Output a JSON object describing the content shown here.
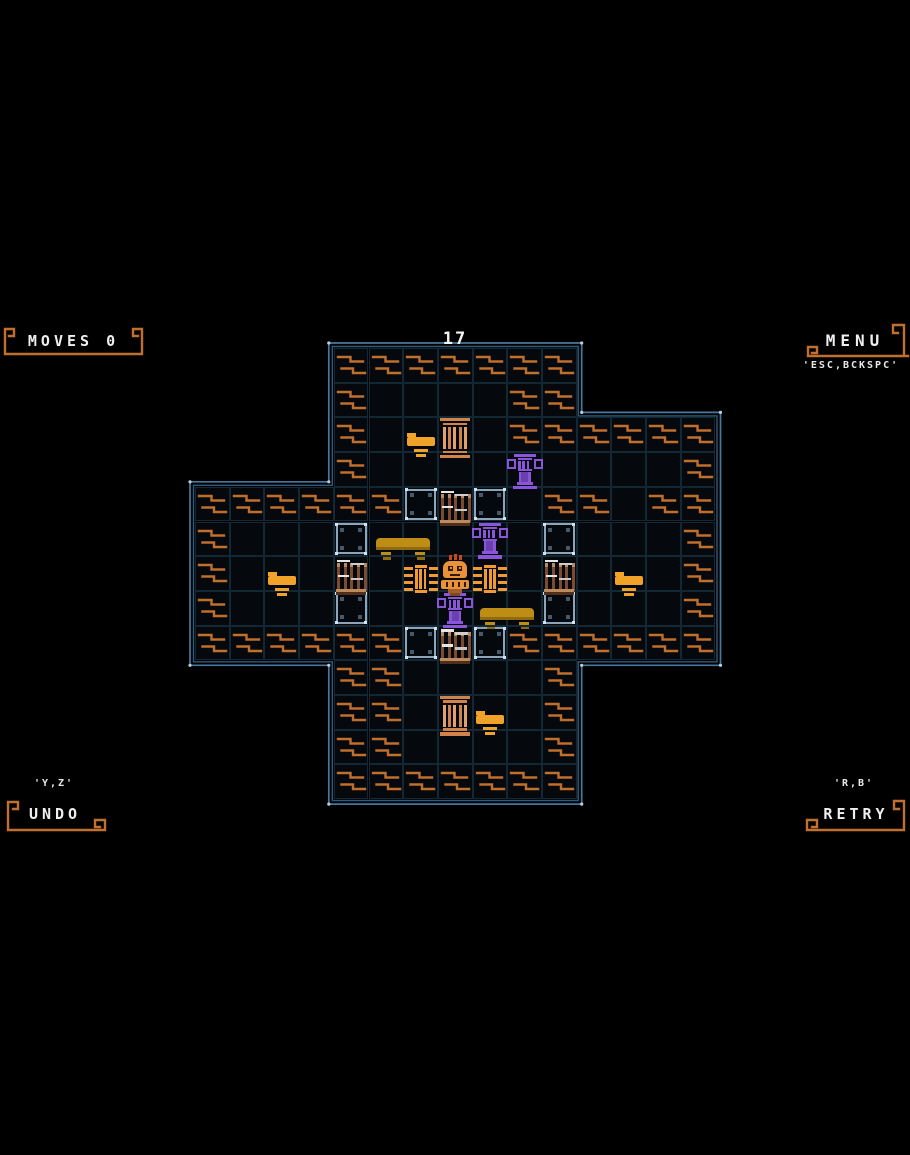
{
  "hud": {
    "moves_label": "MOVES 0",
    "level_number": "17",
    "menu_label": "MENU",
    "menu_keys": "'ESC,BCKSPC'",
    "undo_keys": "'Y,Z'",
    "undo_label": "UNDO",
    "retry_keys": "'R,B'",
    "retry_label": "RETRY"
  },
  "board": {
    "origin": {
      "x": 195,
      "y": 348
    },
    "cell_size": 34.7,
    "regions": [
      {
        "cols": [
          4,
          11
        ],
        "rows": [
          0,
          2
        ]
      },
      {
        "cols": [
          4,
          15
        ],
        "rows": [
          2,
          4
        ]
      },
      {
        "cols": [
          0,
          15
        ],
        "rows": [
          4,
          9
        ]
      },
      {
        "cols": [
          4,
          11
        ],
        "rows": [
          9,
          13
        ]
      }
    ],
    "outline_outer": [
      [
        328.8,
        343
      ],
      [
        581.7,
        343
      ],
      [
        581.7,
        412.4
      ],
      [
        720.5,
        412.4
      ],
      [
        720.5,
        665.3
      ],
      [
        581.7,
        665.3
      ],
      [
        581.7,
        804.1
      ],
      [
        328.8,
        804.1
      ],
      [
        328.8,
        665.3
      ],
      [
        190,
        665.3
      ],
      [
        190,
        481.8
      ],
      [
        328.8,
        481.8
      ]
    ],
    "outline_inner": [
      [
        332.3,
        346.5
      ],
      [
        578.2,
        346.5
      ],
      [
        578.2,
        415.9
      ],
      [
        717,
        415.9
      ],
      [
        717,
        661.8
      ],
      [
        578.2,
        661.8
      ],
      [
        578.2,
        800.6
      ],
      [
        332.3,
        800.6
      ],
      [
        332.3,
        661.8
      ],
      [
        193.5,
        661.8
      ],
      [
        193.5,
        485.3
      ],
      [
        332.3,
        485.3
      ]
    ],
    "waves": [
      [
        4,
        0
      ],
      [
        5,
        0
      ],
      [
        6,
        0
      ],
      [
        7,
        0
      ],
      [
        8,
        0
      ],
      [
        9,
        0
      ],
      [
        10,
        0
      ],
      [
        4,
        1
      ],
      [
        9,
        1
      ],
      [
        10,
        1
      ],
      [
        4,
        2
      ],
      [
        9,
        2
      ],
      [
        10,
        2
      ],
      [
        11,
        2
      ],
      [
        12,
        2
      ],
      [
        13,
        2
      ],
      [
        14,
        2
      ],
      [
        4,
        3
      ],
      [
        14,
        3
      ],
      [
        0,
        4
      ],
      [
        1,
        4
      ],
      [
        2,
        4
      ],
      [
        3,
        4
      ],
      [
        4,
        4
      ],
      [
        5,
        4
      ],
      [
        10,
        4
      ],
      [
        11,
        4
      ],
      [
        13,
        4
      ],
      [
        14,
        4
      ],
      [
        0,
        5
      ],
      [
        14,
        5
      ],
      [
        0,
        6
      ],
      [
        14,
        6
      ],
      [
        0,
        7
      ],
      [
        14,
        7
      ],
      [
        0,
        8
      ],
      [
        1,
        8
      ],
      [
        2,
        8
      ],
      [
        3,
        8
      ],
      [
        4,
        8
      ],
      [
        5,
        8
      ],
      [
        9,
        8
      ],
      [
        10,
        8
      ],
      [
        11,
        8
      ],
      [
        12,
        8
      ],
      [
        13,
        8
      ],
      [
        14,
        8
      ],
      [
        4,
        9
      ],
      [
        5,
        9
      ],
      [
        10,
        9
      ],
      [
        4,
        10
      ],
      [
        5,
        10
      ],
      [
        10,
        10
      ],
      [
        4,
        11
      ],
      [
        5,
        11
      ],
      [
        10,
        11
      ],
      [
        4,
        12
      ],
      [
        5,
        12
      ],
      [
        6,
        12
      ],
      [
        7,
        12
      ],
      [
        8,
        12
      ],
      [
        9,
        12
      ],
      [
        10,
        12
      ]
    ],
    "goals": [
      [
        6,
        4
      ],
      [
        8,
        4
      ],
      [
        4,
        5
      ],
      [
        10,
        5
      ],
      [
        4,
        7
      ],
      [
        10,
        7
      ],
      [
        6,
        8
      ],
      [
        8,
        8
      ]
    ],
    "gates": [
      [
        7,
        4
      ],
      [
        4,
        6
      ],
      [
        10,
        6
      ],
      [
        7,
        8
      ]
    ],
    "fences": [
      [
        6,
        6
      ],
      [
        8,
        6
      ]
    ],
    "pillars_orange": [
      [
        7,
        2
      ],
      [
        7,
        10
      ]
    ],
    "pillars_purple": [
      [
        9,
        3
      ],
      [
        8,
        5
      ],
      [
        7,
        7
      ]
    ],
    "tables": [
      [
        6,
        2
      ],
      [
        2,
        6
      ],
      [
        12,
        6
      ],
      [
        8,
        10
      ]
    ],
    "benches": [
      [
        5,
        5
      ],
      [
        8,
        7
      ]
    ],
    "player": [
      7,
      6
    ]
  },
  "colors": {
    "background": "#000000",
    "wall_outline": "#46789f",
    "wall_outline_inner": "#2f5a7c",
    "wall_corner_dot": "#b9cfe0",
    "grid_line": "#132835",
    "cell_fill": "#05090d",
    "wave": "#a9c7e0",
    "goal_outline": "#8ba6ba",
    "goal_corner_dot": "#d3e2ef",
    "goal_inner_mark": "#45596b",
    "gate_brown": "#7c4a2e",
    "gate_light": "#bd8a5c",
    "gate_white": "#e6e6e6",
    "orange": "#ef9a33",
    "pillar_salmon": "#d0834a",
    "pillar_salmon_light": "#e2a06b",
    "purple": "#8a55d8",
    "purple_dark": "#6a3fb0",
    "table_orange": "#f0a328",
    "bench_gold": "#bd8d15",
    "bench_gold_dark": "#8f6a0e",
    "player_orange": "#e8923a",
    "player_red": "#c2491d",
    "player_dark": "#35180a",
    "hud_frame": "#c06f2c",
    "hud_text": "#efefef"
  }
}
